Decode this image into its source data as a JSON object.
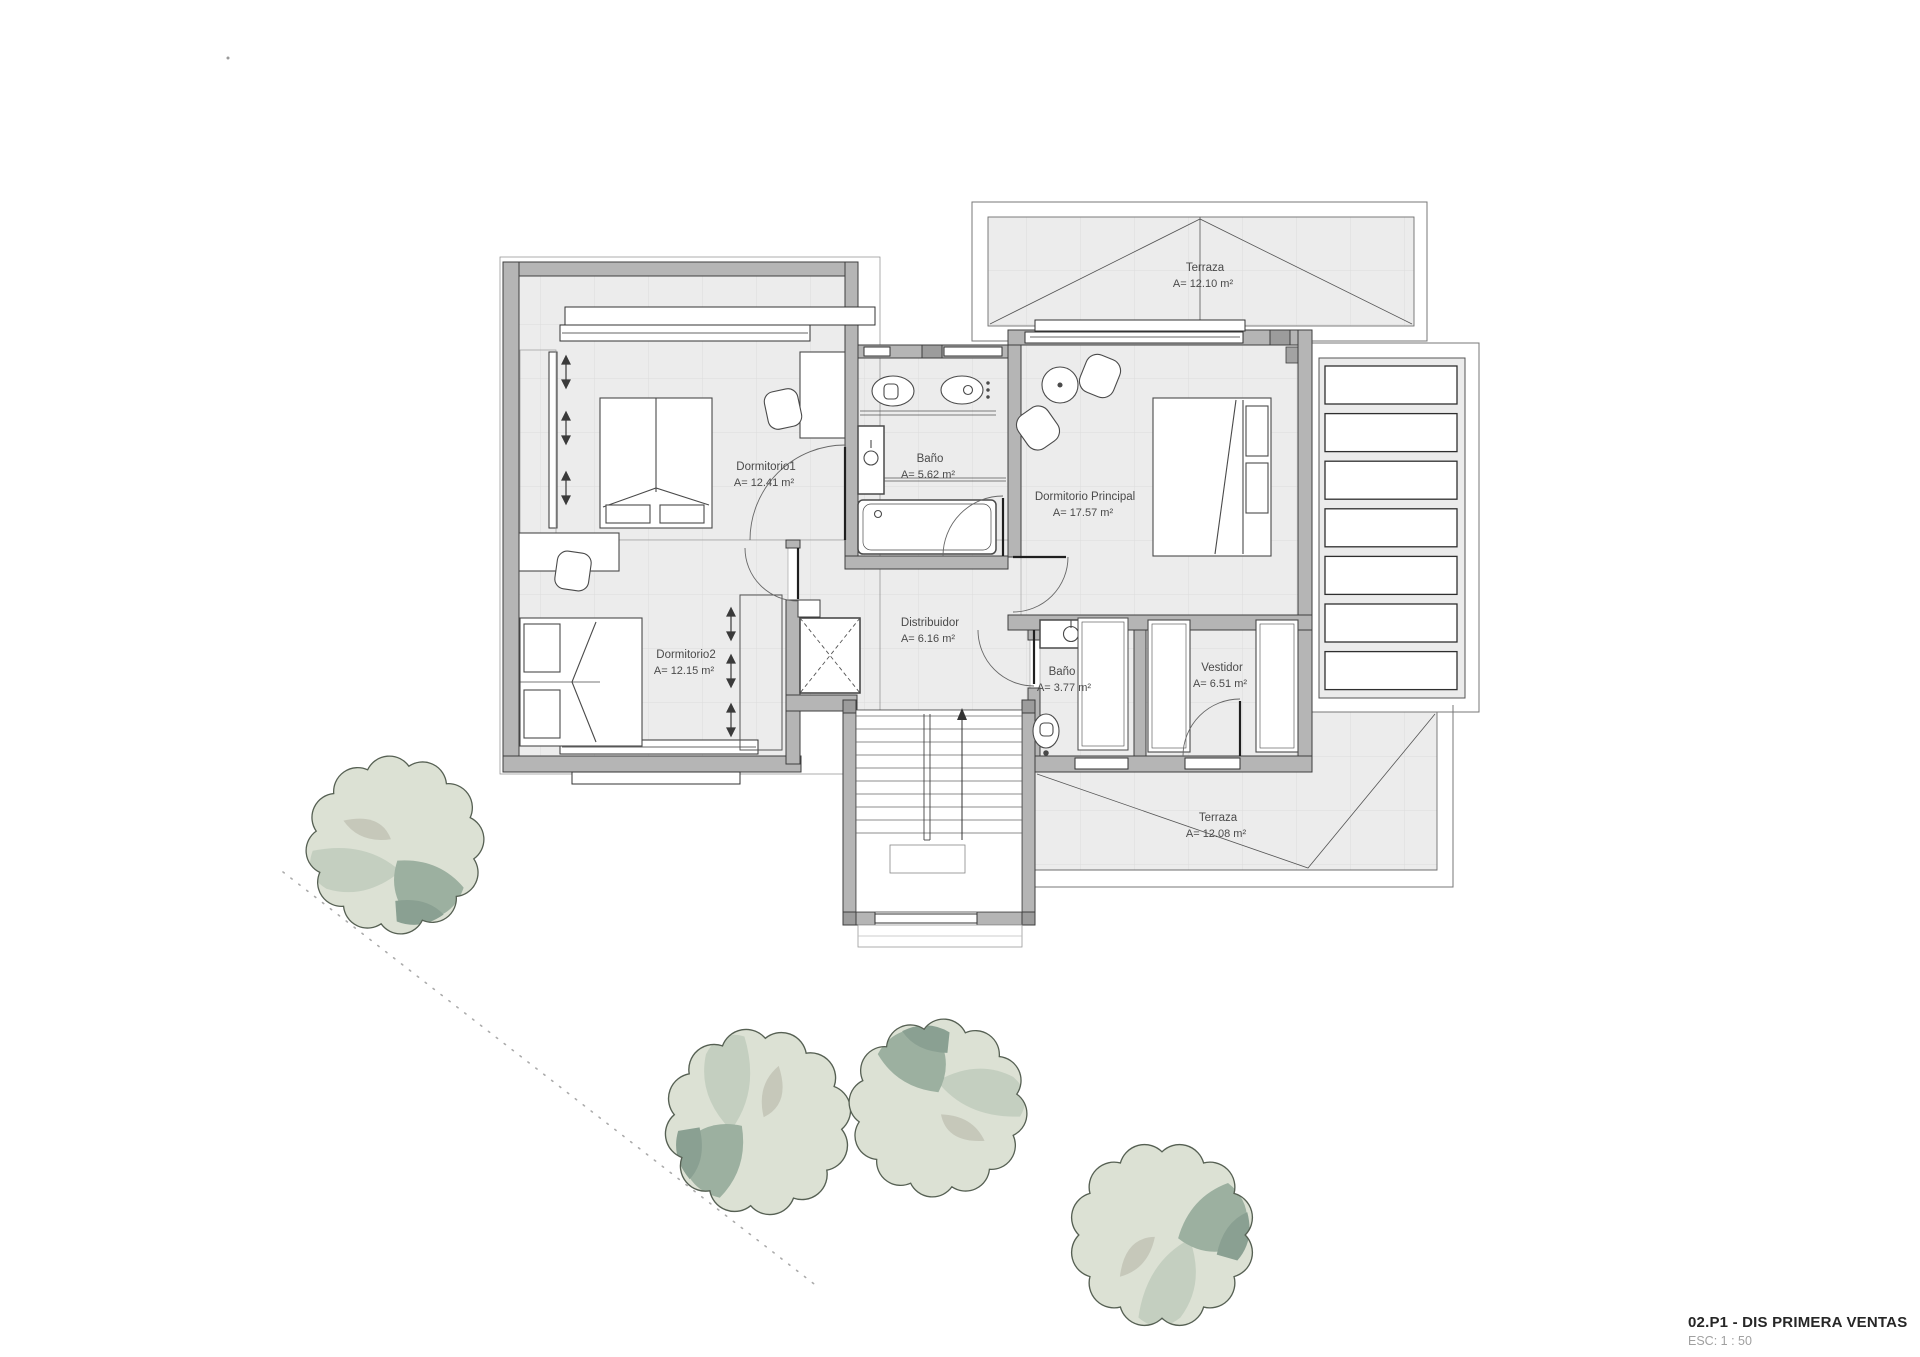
{
  "title_block": {
    "title": "02.P1 - DIS PRIMERA VENTAS",
    "scale": "ESC: 1 : 50"
  },
  "rooms": {
    "dormitorio1": {
      "name": "Dormitorio1",
      "area": "A= 12.41 m²"
    },
    "dormitorio2": {
      "name": "Dormitorio2",
      "area": "A= 12.15 m²"
    },
    "dormitorio_principal": {
      "name": "Dormitorio Principal",
      "area": "A= 17.57 m²"
    },
    "banio_superior": {
      "name": "Baño",
      "area": "A= 5.62 m²"
    },
    "banio_inferior": {
      "name": "Baño",
      "area": "A= 3.77 m²"
    },
    "distribuidor": {
      "name": "Distribuidor",
      "area": "A= 6.16 m²"
    },
    "vestidor": {
      "name": "Vestidor",
      "area": "A= 6.51 m²"
    },
    "terraza_norte": {
      "name": "Terraza",
      "area": "A= 12.10 m²"
    },
    "terraza_sur": {
      "name": "Terraza",
      "area": "A= 12.08 m²"
    }
  },
  "colors": {
    "wall_fill": "#b5b5b5",
    "wall_edge": "#3e3e3e",
    "floor_fill": "#ececec",
    "tile_line": "#dcdcdc",
    "label_text": "#4a4a4a",
    "title_text": "#262626",
    "scale_text": "#a0a0a0",
    "tree_light": "#dce1d4",
    "tree_mid": "#c4cfc0",
    "tree_dark": "#9cb0a0",
    "tree_deep": "#8aa092",
    "tree_beige": "#c6c8ba"
  }
}
